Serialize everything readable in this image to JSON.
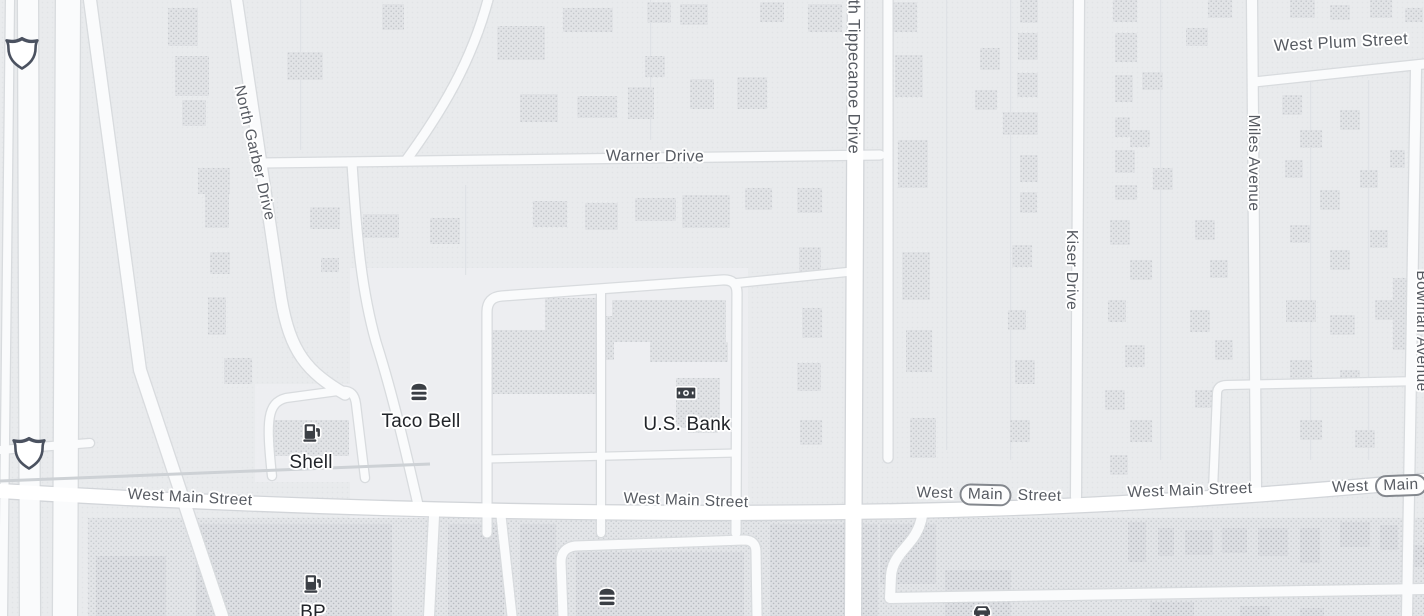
{
  "map": {
    "colors": {
      "land": "#e9ebed",
      "zone_light": "#edeef1",
      "strip": "#e3e5e8",
      "road_minor": "#fafbfc",
      "road_major": "#ffffff",
      "casing_minor": "#d8dbde",
      "casing_major": "#d2d5d9",
      "rail": "#cdd1d5",
      "building_res": "#e1e3e6",
      "building_com": "#dddfe3",
      "street_label": "#565a61",
      "poi_label": "#212429",
      "icon": "#3b3f45",
      "shield_border": "#4b5260",
      "lot_line": "#dfe2e6"
    },
    "street_labels": [
      {
        "text": "North Garber Drive",
        "x": 254,
        "y": 153,
        "rotate": 77,
        "size": 15.5
      },
      {
        "text": "Warner Drive",
        "x": 655,
        "y": 157,
        "rotate": 0.5,
        "size": 16
      },
      {
        "text": "North Tippecanoe Drive",
        "x": 853,
        "y": 63,
        "rotate": 90,
        "size": 16.5
      },
      {
        "text": "West Plum Street",
        "x": 1341,
        "y": 43,
        "rotate": -3,
        "size": 16.5
      },
      {
        "text": "Miles Avenue",
        "x": 1253,
        "y": 163,
        "rotate": 90,
        "size": 15.5
      },
      {
        "text": "Kiser Drive",
        "x": 1071,
        "y": 270,
        "rotate": 90,
        "size": 15.5
      },
      {
        "text": "Bowman Avenue",
        "x": 1421,
        "y": 331,
        "rotate": 90,
        "size": 15.5
      },
      {
        "text": "West Main Street",
        "x": 190,
        "y": 498,
        "rotate": 3,
        "size": 15.5
      },
      {
        "text": "West Main Street",
        "x": 686,
        "y": 501,
        "rotate": 2,
        "size": 15.5
      },
      {
        "prefix": "West",
        "badge": "Main",
        "suffix": "Street",
        "x": 989,
        "y": 495,
        "rotate": 1.5,
        "size": 15.5
      },
      {
        "text": "West Main Street",
        "x": 1190,
        "y": 491,
        "rotate": -2,
        "size": 15.5
      },
      {
        "prefix": "West",
        "badge": "Main",
        "suffix": "S",
        "x": 1388,
        "y": 486,
        "rotate": -2,
        "size": 15.5
      }
    ],
    "pois": [
      {
        "name": "Taco Bell",
        "icon": "restaurant",
        "icon_x": 419,
        "icon_y": 391,
        "label_x": 421,
        "label_y": 422
      },
      {
        "name": "Shell",
        "icon": "fuel",
        "icon_x": 312,
        "icon_y": 432,
        "label_x": 311,
        "label_y": 463
      },
      {
        "name": "U.S. Bank",
        "icon": "bank",
        "icon_x": 686,
        "icon_y": 393,
        "label_x": 687,
        "label_y": 425
      },
      {
        "name": "BP",
        "icon": "fuel",
        "icon_x": 313,
        "icon_y": 583,
        "label_x": 313,
        "label_y": 613
      },
      {
        "name": "",
        "icon": "restaurant",
        "icon_x": 607,
        "icon_y": 596
      },
      {
        "name": "",
        "icon": "car",
        "icon_x": 982,
        "icon_y": 610
      }
    ],
    "shields": [
      {
        "type": "interstate-blank",
        "x": 22,
        "y": 52
      },
      {
        "type": "interstate-blank",
        "x": 29,
        "y": 452
      }
    ],
    "zones": [
      {
        "x": 350,
        "y": 268,
        "w": 398,
        "h": 250
      },
      {
        "x": 255,
        "y": 384,
        "w": 112,
        "h": 98
      }
    ],
    "strip": {
      "x": 88,
      "y": 518,
      "w": 1336,
      "h": 98
    },
    "roads": [
      {
        "d": "M 10,0 L 3,616",
        "w": 8
      },
      {
        "d": "M 28,0 L 30,616",
        "w": 20
      },
      {
        "d": "M 68,0 L 65,616",
        "w": 24
      },
      {
        "d": "M 90,0 L 140,370 L 222,616",
        "w": 12
      },
      {
        "d": "M 236,-4 L 281,298 C 290,352 307,372 345,394",
        "w": 11
      },
      {
        "d": "M 262,163 L 880,155",
        "w": 9
      },
      {
        "d": "M 489,-4 C 472,62 441,112 407,159",
        "w": 9
      },
      {
        "d": "M 0,450 L 90,443",
        "w": 8
      },
      {
        "d": "M 888,0 L 888,458",
        "w": 9
      },
      {
        "d": "M 1079,0 L 1076,497",
        "w": 10
      },
      {
        "d": "M 1252,0 L 1256,488",
        "w": 10
      },
      {
        "d": "M 1416,68 L 1407,616",
        "w": 10
      },
      {
        "d": "M 1254,82 L 1424,64",
        "w": 9
      },
      {
        "d": "M 272,476 C 266,420 267,403 286,398 L 338,391 C 352,389 355,396 356,404 L 365,478",
        "w": 8
      },
      {
        "d": "M 352,163 C 357,242 362,292 376,342 C 392,392 406,452 419,509",
        "w": 9
      },
      {
        "d": "M 487,533 L 487,312 Q 487,297 502,296 L 722,280 Q 737,279 737,293 L 736,533",
        "w": 9
      },
      {
        "d": "M 601,291 L 601,533",
        "w": 8
      },
      {
        "d": "M 487,459 L 736,453",
        "w": 7
      },
      {
        "d": "M 737,283 L 857,271",
        "w": 8
      },
      {
        "d": "M 434,516 L 429,616",
        "w": 10
      },
      {
        "d": "M 501,516 L 512,616",
        "w": 9
      },
      {
        "d": "M 563,616 L 561,562 Q 561,548 575,546 L 744,540 Q 756,540 756,552 L 757,616",
        "w": 9
      },
      {
        "d": "M 922,516 C 917,546 893,550 891,576 L 890,598 L 1424,589",
        "w": 10
      },
      {
        "d": "M 1213,490 L 1217,394 Q 1217,385 1227,385 L 1424,381",
        "w": 8
      },
      {
        "d": "M 856,0 L 853,616",
        "w": 16,
        "major": true
      },
      {
        "d": "M 0,491 C 380,514 760,518 1040,507 C 1210,500 1330,489 1424,481",
        "w": 14,
        "major": true
      }
    ],
    "rail": {
      "d": "M 0,481 L 430,464",
      "w": 3
    },
    "lot_lines": [
      [
        300,
        0,
        150
      ],
      [
        650,
        0,
        140
      ],
      [
        1010,
        0,
        460
      ],
      [
        1160,
        0,
        460
      ],
      [
        1310,
        80,
        380
      ],
      [
        1368,
        80,
        380
      ],
      [
        465,
        185,
        90
      ],
      [
        946,
        0,
        450
      ]
    ],
    "buildings": {
      "residential": [
        [
          168,
          8,
          30,
          38
        ],
        [
          175,
          56,
          34,
          40
        ],
        [
          182,
          100,
          24,
          26
        ],
        [
          198,
          168,
          32,
          26
        ],
        [
          205,
          192,
          24,
          36
        ],
        [
          210,
          252,
          20,
          22
        ],
        [
          208,
          297,
          18,
          38
        ],
        [
          224,
          358,
          28,
          26
        ],
        [
          287,
          52,
          36,
          28
        ],
        [
          310,
          207,
          30,
          22
        ],
        [
          321,
          258,
          18,
          14
        ],
        [
          363,
          214,
          36,
          24
        ],
        [
          382,
          4,
          22,
          26
        ],
        [
          430,
          218,
          30,
          26
        ],
        [
          497,
          26,
          48,
          34
        ],
        [
          563,
          8,
          50,
          24
        ],
        [
          520,
          94,
          38,
          28
        ],
        [
          577,
          96,
          40,
          22
        ],
        [
          628,
          87,
          26,
          32
        ],
        [
          647,
          2,
          24,
          21
        ],
        [
          680,
          4,
          28,
          21
        ],
        [
          690,
          79,
          24,
          30
        ],
        [
          737,
          77,
          30,
          32
        ],
        [
          645,
          56,
          20,
          21
        ],
        [
          760,
          2,
          24,
          20
        ],
        [
          808,
          4,
          34,
          28
        ],
        [
          883,
          2,
          34,
          30
        ],
        [
          533,
          201,
          34,
          26
        ],
        [
          585,
          203,
          33,
          27
        ],
        [
          635,
          198,
          41,
          23
        ],
        [
          682,
          195,
          48,
          33
        ],
        [
          745,
          188,
          27,
          22
        ],
        [
          797,
          188,
          25,
          25
        ],
        [
          799,
          247,
          22,
          26
        ],
        [
          802,
          308,
          20,
          30
        ],
        [
          797,
          363,
          24,
          28
        ],
        [
          800,
          420,
          22,
          25
        ],
        [
          895,
          55,
          28,
          42
        ],
        [
          898,
          140,
          30,
          48
        ],
        [
          902,
          252,
          28,
          48
        ],
        [
          906,
          330,
          26,
          42
        ],
        [
          910,
          418,
          26,
          40
        ],
        [
          1020,
          0,
          18,
          23
        ],
        [
          1018,
          33,
          20,
          27
        ],
        [
          980,
          48,
          20,
          22
        ],
        [
          1017,
          73,
          21,
          24
        ],
        [
          975,
          90,
          22,
          20
        ],
        [
          1003,
          112,
          35,
          23
        ],
        [
          1020,
          155,
          18,
          27
        ],
        [
          1020,
          192,
          17,
          21
        ],
        [
          1012,
          245,
          20,
          22
        ],
        [
          1008,
          310,
          18,
          20
        ],
        [
          1015,
          360,
          20,
          24
        ],
        [
          1010,
          420,
          20,
          22
        ],
        [
          1113,
          0,
          24,
          22
        ],
        [
          1115,
          33,
          22,
          29
        ],
        [
          1115,
          75,
          18,
          27
        ],
        [
          1142,
          72,
          21,
          18
        ],
        [
          1115,
          117,
          15,
          20
        ],
        [
          1130,
          130,
          20,
          17
        ],
        [
          1115,
          150,
          20,
          23
        ],
        [
          1153,
          168,
          20,
          22
        ],
        [
          1115,
          185,
          22,
          15
        ],
        [
          1186,
          28,
          22,
          18
        ],
        [
          1208,
          0,
          24,
          18
        ],
        [
          1110,
          220,
          20,
          25
        ],
        [
          1130,
          260,
          22,
          20
        ],
        [
          1108,
          300,
          18,
          22
        ],
        [
          1125,
          345,
          20,
          22
        ],
        [
          1105,
          390,
          20,
          20
        ],
        [
          1130,
          420,
          22,
          22
        ],
        [
          1110,
          455,
          18,
          20
        ],
        [
          1195,
          220,
          20,
          20
        ],
        [
          1210,
          260,
          18,
          18
        ],
        [
          1190,
          310,
          20,
          22
        ],
        [
          1215,
          340,
          18,
          20
        ],
        [
          1195,
          390,
          18,
          18
        ],
        [
          1290,
          0,
          25,
          18
        ],
        [
          1330,
          5,
          20,
          15
        ],
        [
          1370,
          0,
          22,
          18
        ],
        [
          1405,
          8,
          18,
          14
        ],
        [
          1282,
          95,
          20,
          20
        ],
        [
          1300,
          130,
          22,
          18
        ],
        [
          1340,
          110,
          20,
          20
        ],
        [
          1285,
          160,
          18,
          18
        ],
        [
          1320,
          190,
          20,
          20
        ],
        [
          1360,
          170,
          18,
          18
        ],
        [
          1290,
          225,
          20,
          18
        ],
        [
          1330,
          250,
          20,
          20
        ],
        [
          1370,
          230,
          18,
          18
        ],
        [
          1286,
          300,
          30,
          22
        ],
        [
          1330,
          315,
          25,
          20
        ],
        [
          1375,
          300,
          20,
          20
        ],
        [
          1290,
          360,
          22,
          20
        ],
        [
          1340,
          370,
          20,
          18
        ],
        [
          1300,
          420,
          22,
          20
        ],
        [
          1355,
          430,
          20,
          18
        ],
        [
          1390,
          150,
          15,
          18
        ],
        [
          1393,
          278,
          30,
          72
        ],
        [
          545,
          298,
          52,
          34
        ],
        [
          490,
          330,
          108,
          64
        ],
        [
          612,
          300,
          114,
          42
        ],
        [
          578,
          316,
          36,
          44
        ],
        [
          650,
          342,
          78,
          20
        ],
        [
          676,
          378,
          44,
          50
        ],
        [
          688,
          405,
          30,
          28
        ],
        [
          273,
          420,
          76,
          36
        ]
      ],
      "commercial": [
        [
          96,
          556,
          70,
          60
        ],
        [
          196,
          524,
          196,
          92
        ],
        [
          448,
          524,
          56,
          92
        ],
        [
          520,
          524,
          36,
          92
        ],
        [
          576,
          552,
          168,
          64
        ],
        [
          770,
          524,
          108,
          92
        ],
        [
          880,
          524,
          56,
          60
        ],
        [
          945,
          570,
          66,
          46
        ],
        [
          1128,
          522,
          18,
          40
        ],
        [
          1158,
          528,
          16,
          28
        ],
        [
          1185,
          530,
          28,
          25
        ],
        [
          1222,
          528,
          25,
          25
        ],
        [
          1258,
          528,
          30,
          28
        ],
        [
          1300,
          528,
          20,
          35
        ],
        [
          1340,
          522,
          30,
          25
        ],
        [
          1380,
          525,
          18,
          25
        ],
        [
          1410,
          545,
          14,
          22
        ],
        [
          1150,
          602,
          44,
          14
        ],
        [
          1240,
          606,
          30,
          10
        ],
        [
          1300,
          608,
          24,
          8
        ],
        [
          620,
          606,
          50,
          10
        ],
        [
          450,
          604,
          40,
          12
        ]
      ]
    }
  }
}
